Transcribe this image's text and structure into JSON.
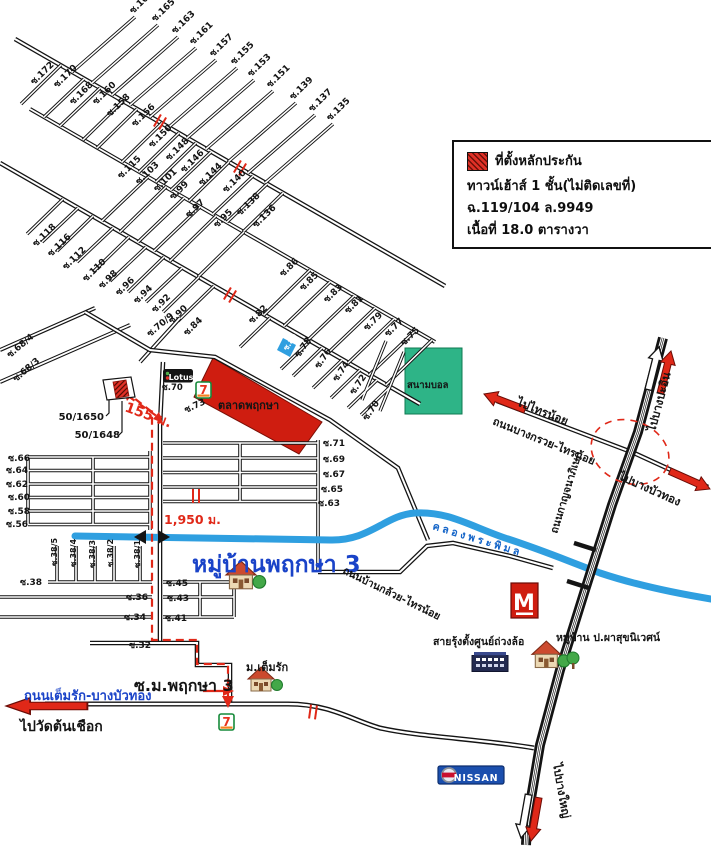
{
  "legend": {
    "title": "ที่ตั้งหลักประกัน",
    "line2": "ทาวน์เฮ้าส์ 1 ชั้น(ไม่ติดเลขที่)",
    "line3": "ฉ.119/104  ล.9949",
    "line4": "เนื้อที่ 18.0 ตารางวา"
  },
  "colors": {
    "road": "#141414",
    "route_red": "#e02818",
    "canal_blue": "#2f9fe0",
    "market_red": "#cf1d10",
    "field_green": "#2eb487",
    "label_blue": "#1a43c8",
    "nissan_blue": "#1b4fae"
  },
  "labels": [
    {
      "t": "ซ.167",
      "x": 133,
      "y": 14,
      "r": -44
    },
    {
      "t": "ซ.165",
      "x": 155,
      "y": 22,
      "r": -44
    },
    {
      "t": "ซ.163",
      "x": 175,
      "y": 34,
      "r": -44
    },
    {
      "t": "ซ.161",
      "x": 193,
      "y": 45,
      "r": -44
    },
    {
      "t": "ซ.157",
      "x": 213,
      "y": 57,
      "r": -44
    },
    {
      "t": "ซ.155",
      "x": 234,
      "y": 65,
      "r": -44
    },
    {
      "t": "ซ.153",
      "x": 251,
      "y": 77,
      "r": -44
    },
    {
      "t": "ซ.151",
      "x": 270,
      "y": 88,
      "r": -44
    },
    {
      "t": "ซ.139",
      "x": 293,
      "y": 100,
      "r": -44
    },
    {
      "t": "ซ.137",
      "x": 312,
      "y": 112,
      "r": -44
    },
    {
      "t": "ซ.135",
      "x": 330,
      "y": 121,
      "r": -44
    },
    {
      "t": "ซ.172",
      "x": 34,
      "y": 85,
      "r": -44
    },
    {
      "t": "ซ.170",
      "x": 57,
      "y": 88,
      "r": -44
    },
    {
      "t": "ซ.168",
      "x": 73,
      "y": 105,
      "r": -44
    },
    {
      "t": "ซ.160",
      "x": 96,
      "y": 105,
      "r": -44
    },
    {
      "t": "ซ.158",
      "x": 110,
      "y": 117,
      "r": -44
    },
    {
      "t": "ซ.156",
      "x": 135,
      "y": 127,
      "r": -44
    },
    {
      "t": "ซ.150",
      "x": 152,
      "y": 148,
      "r": -44
    },
    {
      "t": "ซ.148",
      "x": 169,
      "y": 161,
      "r": -44
    },
    {
      "t": "ซ.146",
      "x": 184,
      "y": 173,
      "r": -44
    },
    {
      "t": "ซ.144",
      "x": 202,
      "y": 186,
      "r": -44
    },
    {
      "t": "ซ.140",
      "x": 226,
      "y": 193,
      "r": -44
    },
    {
      "t": "ซ.138",
      "x": 240,
      "y": 216,
      "r": -44
    },
    {
      "t": "ซ.136",
      "x": 256,
      "y": 228,
      "r": -44
    },
    {
      "t": "ซ.115",
      "x": 121,
      "y": 179,
      "r": -44
    },
    {
      "t": "ซ.103",
      "x": 139,
      "y": 185,
      "r": -44
    },
    {
      "t": "ซ.101",
      "x": 157,
      "y": 192,
      "r": -44
    },
    {
      "t": "ซ.99",
      "x": 173,
      "y": 200,
      "r": -44
    },
    {
      "t": "ซ.97",
      "x": 189,
      "y": 218,
      "r": -44
    },
    {
      "t": "ซ.95",
      "x": 217,
      "y": 228,
      "r": -44
    },
    {
      "t": "ซ.86",
      "x": 283,
      "y": 277,
      "r": -44
    },
    {
      "t": "ซ.85",
      "x": 303,
      "y": 291,
      "r": -44
    },
    {
      "t": "ซ.83",
      "x": 327,
      "y": 303,
      "r": -44
    },
    {
      "t": "ซ.81",
      "x": 348,
      "y": 314,
      "r": -44
    },
    {
      "t": "ซ.79",
      "x": 367,
      "y": 331,
      "r": -44
    },
    {
      "t": "ซ.77",
      "x": 388,
      "y": 337,
      "r": -44
    },
    {
      "t": "ซ.75",
      "x": 404,
      "y": 346,
      "r": -44
    },
    {
      "t": "ซ.118",
      "x": 36,
      "y": 247,
      "r": -44
    },
    {
      "t": "ซ.116",
      "x": 51,
      "y": 257,
      "r": -44
    },
    {
      "t": "ซ.112",
      "x": 66,
      "y": 270,
      "r": -44
    },
    {
      "t": "ซ.110",
      "x": 86,
      "y": 282,
      "r": -44
    },
    {
      "t": "ซ.98",
      "x": 102,
      "y": 289,
      "r": -44
    },
    {
      "t": "ซ.96",
      "x": 119,
      "y": 296,
      "r": -44
    },
    {
      "t": "ซ.94",
      "x": 137,
      "y": 304,
      "r": -44
    },
    {
      "t": "ซ.92",
      "x": 155,
      "y": 313,
      "r": -44
    },
    {
      "t": "ซ.90",
      "x": 172,
      "y": 324,
      "r": -44
    },
    {
      "t": "ซ.84",
      "x": 187,
      "y": 336,
      "r": -44
    },
    {
      "t": "ซ.82",
      "x": 252,
      "y": 324,
      "r": -44
    },
    {
      "t": "ซ.70/9",
      "x": 150,
      "y": 337,
      "r": -40
    },
    {
      "t": "ซ.68/4",
      "x": 10,
      "y": 358,
      "r": -40
    },
    {
      "t": "ซ.68/3",
      "x": 16,
      "y": 382,
      "r": -40
    },
    {
      "t": "ซ.70",
      "x": 162,
      "y": 390,
      "s": 8.5
    },
    {
      "t": "ซ.73",
      "x": 186,
      "y": 413,
      "r": -25
    },
    {
      "t": "ซ.80",
      "x": 287,
      "y": 351,
      "r": -55,
      "s": 7.5,
      "c": "#ffffff"
    },
    {
      "t": "ซ.78",
      "x": 299,
      "y": 358,
      "r": -55
    },
    {
      "t": "ซ.76",
      "x": 319,
      "y": 369,
      "r": -55
    },
    {
      "t": "ซ.74",
      "x": 337,
      "y": 382,
      "r": -55
    },
    {
      "t": "ซ.72",
      "x": 354,
      "y": 395,
      "r": -55
    },
    {
      "t": "ซ.70",
      "x": 367,
      "y": 421,
      "r": -55
    },
    {
      "t": "ซ.66",
      "x": 8,
      "y": 461
    },
    {
      "t": "ซ.64",
      "x": 6,
      "y": 473
    },
    {
      "t": "ซ.62",
      "x": 6,
      "y": 487
    },
    {
      "t": "ซ.60",
      "x": 8,
      "y": 500
    },
    {
      "t": "ซ.58",
      "x": 8,
      "y": 514
    },
    {
      "t": "ซ.56",
      "x": 6,
      "y": 527
    },
    {
      "t": "ซ.71",
      "x": 323,
      "y": 446
    },
    {
      "t": "ซ.69",
      "x": 323,
      "y": 462
    },
    {
      "t": "ซ.67",
      "x": 323,
      "y": 477
    },
    {
      "t": "ซ.65",
      "x": 321,
      "y": 492
    },
    {
      "t": "ซ.63",
      "x": 318,
      "y": 506
    },
    {
      "t": "ซ.38",
      "x": 20,
      "y": 585
    },
    {
      "t": "ซ.38/5",
      "x": 57,
      "y": 566,
      "r": -90,
      "s": 8
    },
    {
      "t": "ซ.38/4",
      "x": 76,
      "y": 567,
      "r": -90,
      "s": 8
    },
    {
      "t": "ซ.38/3",
      "x": 95,
      "y": 568,
      "r": -90,
      "s": 8
    },
    {
      "t": "ซ.38/2",
      "x": 113,
      "y": 567,
      "r": -90,
      "s": 8
    },
    {
      "t": "ซ.38/1",
      "x": 140,
      "y": 568,
      "r": -90,
      "s": 8
    },
    {
      "t": "ซ.36",
      "x": 126,
      "y": 600
    },
    {
      "t": "ซ.34",
      "x": 124,
      "y": 620
    },
    {
      "t": "ซ.32",
      "x": 129,
      "y": 648
    },
    {
      "t": "ซ.45",
      "x": 166,
      "y": 586
    },
    {
      "t": "ซ.43",
      "x": 167,
      "y": 601
    },
    {
      "t": "ซ.41",
      "x": 165,
      "y": 621
    },
    {
      "t": "ตลาดพฤกษา",
      "x": 218,
      "y": 409,
      "s": 11,
      "n": "market-label"
    },
    {
      "t": "สนามบอล",
      "x": 407,
      "y": 388,
      "s": 9.5,
      "n": "football-field-label"
    },
    {
      "t": "หมู่บ้านพฤกษา 3",
      "x": 192,
      "y": 572,
      "s": 23,
      "c": "#1a43c8",
      "n": "village-pruksa3-label"
    },
    {
      "t": "ซ.ม.พฤกษา 3",
      "x": 134,
      "y": 691,
      "s": 16,
      "n": "soi-mu-pruksa3-label"
    },
    {
      "t": "ถนนเต็มรัก-บางบัวทอง",
      "x": 24,
      "y": 700,
      "s": 13,
      "c": "#1a43c8",
      "n": "temrak-road-label"
    },
    {
      "t": "ไปวัดต้นเชือก",
      "x": 20,
      "y": 731,
      "s": 14,
      "n": "to-wat-tonchueak-label"
    },
    {
      "t": "ม.เต็มรัก",
      "x": 246,
      "y": 671,
      "s": 11,
      "n": "mu-temrak-label"
    },
    {
      "t": "สายรุ้งตั้งศูนย์ถ่วงล้อ",
      "x": 433,
      "y": 645,
      "s": 10.5,
      "n": "sairung-wheel-shop-label"
    },
    {
      "t": "หมู่บ้าน ป.ผาสุขนิเวศน์",
      "x": 556,
      "y": 641,
      "s": 10.5,
      "n": "pasuk-village-label"
    },
    {
      "t": "ถนนบ้านกล้วย-ไทรน้อย",
      "x": 342,
      "y": 573,
      "r": 26,
      "s": 10.5,
      "n": "bankluai-road-label"
    },
    {
      "t": "คลองพระพิมล",
      "x": 432,
      "y": 529,
      "r": 17,
      "s": 10.5,
      "c": "#1565c8",
      "l": 3,
      "n": "khlong-phraphimon-label"
    },
    {
      "t": "ถนนบางกรวย-ไทรน้อย",
      "x": 492,
      "y": 424,
      "r": 22,
      "s": 11,
      "n": "bangkruai-road-label"
    },
    {
      "t": "ไปไทรน้อย",
      "x": 516,
      "y": 405,
      "r": 22,
      "s": 11.5,
      "n": "to-sainoi-label"
    },
    {
      "t": "ไปบางปะอิน",
      "x": 655,
      "y": 432,
      "r": -75,
      "s": 11.5,
      "n": "to-bangpain-label"
    },
    {
      "t": "ไปบางบัวทอง",
      "x": 618,
      "y": 479,
      "r": 24,
      "s": 11.5,
      "n": "to-bangbuathong-label"
    },
    {
      "t": "ไปบางใหญ่",
      "x": 553,
      "y": 764,
      "r": 80,
      "s": 11.5,
      "n": "to-bangyai-label"
    },
    {
      "t": "ถนนกาญจนาภิเษก",
      "x": 557,
      "y": 534,
      "r": -73,
      "s": 10.5,
      "n": "kanchanaphisek-label"
    },
    {
      "t": "155 ม.",
      "x": 124,
      "y": 411,
      "r": 20,
      "s": 14,
      "c": "#e02818",
      "n": "distance-155m"
    },
    {
      "t": "1,950 ม.",
      "x": 164,
      "y": 524,
      "s": 12.5,
      "c": "#e02818",
      "n": "distance-1950m"
    },
    {
      "t": "50/1650",
      "x": 104,
      "y": 420,
      "a": "end",
      "s": 10,
      "n": "house-no-50-1650"
    },
    {
      "t": "50/1648",
      "x": 120,
      "y": 438,
      "a": "end",
      "s": 10,
      "n": "house-no-50-1648"
    },
    {
      "t": "NISSAN",
      "x": 476,
      "y": 781,
      "s": 9.5,
      "c": "#ffffff",
      "a": "middle",
      "l": 0.8,
      "n": "nissan-text"
    },
    {
      "t": "Lotus",
      "x": 181,
      "y": 380,
      "s": 8,
      "c": "#ffffff",
      "a": "middle",
      "n": "lotus-text"
    },
    {
      "t": "M",
      "x": 524,
      "y": 610,
      "s": 22,
      "c": "#ffffff",
      "a": "middle",
      "n": "m-logo-letter"
    },
    {
      "t": "7",
      "x": 203.5,
      "y": 394,
      "s": 12,
      "c": "#e8321e",
      "a": "middle",
      "n": "seven-eleven-7"
    },
    {
      "t": "7",
      "x": 226.5,
      "y": 726,
      "s": 12,
      "c": "#e8321e",
      "a": "middle",
      "n": "seven-eleven-7"
    }
  ]
}
